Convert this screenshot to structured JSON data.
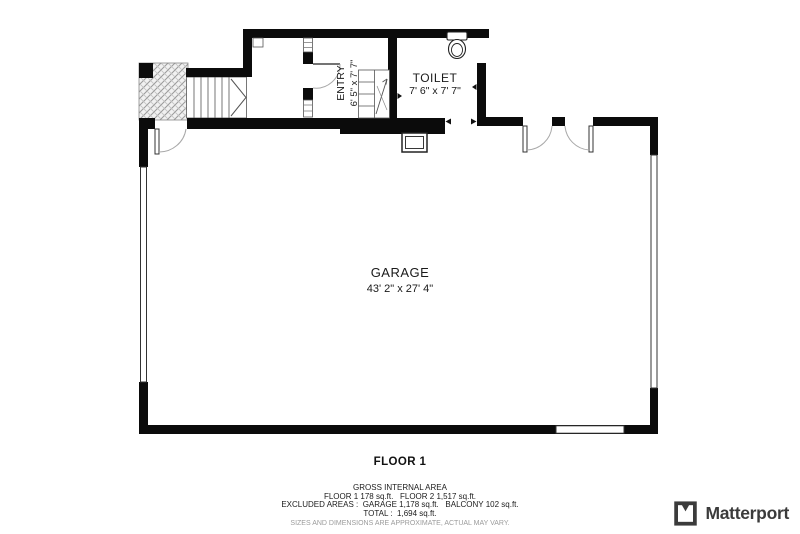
{
  "plan": {
    "rooms": {
      "entry": {
        "name": "ENTRY",
        "dims": "6' 5\" x 7' 7\""
      },
      "toilet": {
        "name": "TOILET",
        "dims": "7' 6\" x 7' 7\""
      },
      "garage": {
        "name": "GARAGE",
        "dims": "43' 2\" x 27' 4\""
      }
    },
    "floor_label": "FLOOR 1"
  },
  "footer": {
    "title": "GROSS INTERNAL AREA",
    "line_floors": "FLOOR 1 178 sq.ft.   FLOOR 2 1,517 sq.ft.",
    "line_excluded": "EXCLUDED AREAS :  GARAGE 1,178 sq.ft.   BALCONY 102 sq.ft.",
    "line_total": "TOTAL :  1,694 sq.ft.",
    "disclaimer": "SIZES AND DIMENSIONS ARE APPROXIMATE, ACTUAL MAY VARY."
  },
  "brand": {
    "wordmark": "Matterport"
  }
}
